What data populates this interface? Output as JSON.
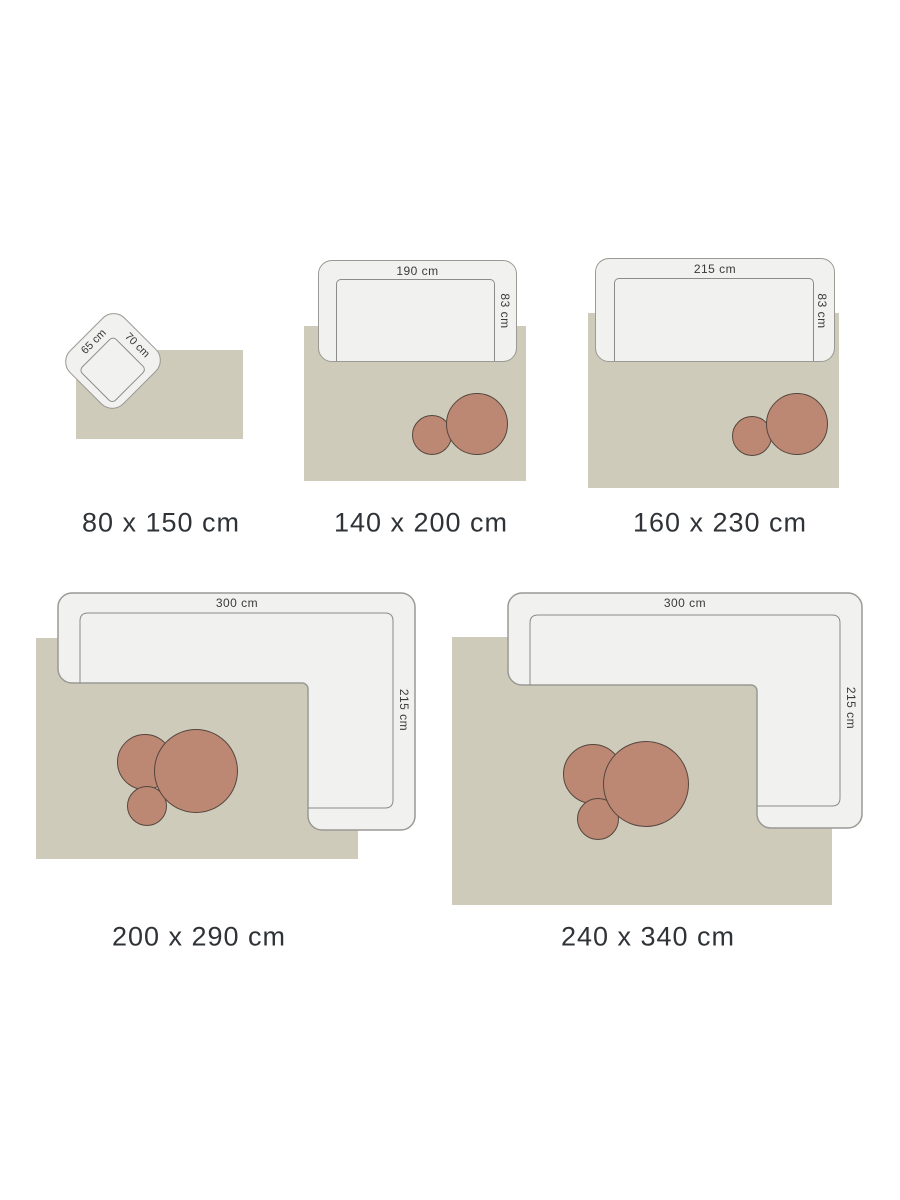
{
  "colors": {
    "background": "#ffffff",
    "rug_fill": "#cecbba",
    "furniture_fill": "#f1f1ef",
    "furniture_outline": "#9a9995",
    "pouf_fill": "#bc8874",
    "pouf_outline": "#55463d",
    "caption_text": "#2f3337",
    "dimension_text": "#3a3a3a"
  },
  "items": [
    {
      "size_label": "80 x 150 cm",
      "furniture_width_label": "65 cm",
      "furniture_depth_label": "70 cm"
    },
    {
      "size_label": "140 x 200 cm",
      "furniture_width_label": "190 cm",
      "furniture_depth_label": "83 cm"
    },
    {
      "size_label": "160 x 230 cm",
      "furniture_width_label": "215 cm",
      "furniture_depth_label": "83 cm"
    },
    {
      "size_label": "200 x 290 cm",
      "furniture_width_label": "300 cm",
      "furniture_depth_label": "215 cm"
    },
    {
      "size_label": "240 x 340 cm",
      "furniture_width_label": "300 cm",
      "furniture_depth_label": "215 cm"
    }
  ]
}
